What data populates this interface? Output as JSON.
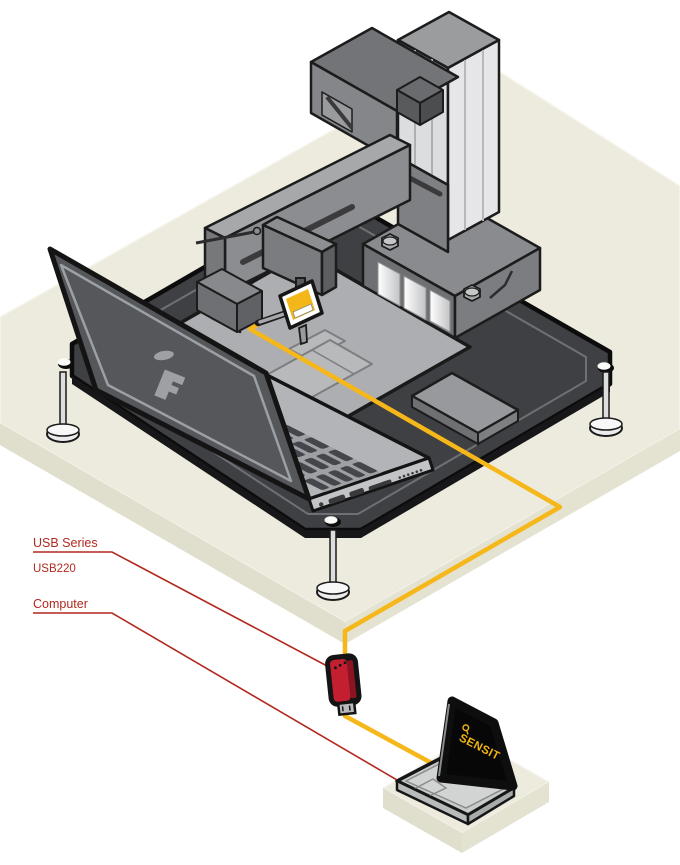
{
  "illustration": {
    "description": "Isometric technical diagram: laptop test machine on platform, connected by cable through a USB adapter to a computer",
    "callouts": [
      {
        "label": "USB Series",
        "sublabel": "USB220",
        "target": "usb-adapter"
      },
      {
        "label": "Computer",
        "target": "computer-laptop"
      }
    ],
    "callout_color": "#b2291f",
    "cable_color": "#f6b71b",
    "usb_adapter_color": "#c41f30",
    "computer_screen_logo": "SENSIT",
    "computer_screen_logo_color": "#f0b411",
    "platform_color": "#3f4043",
    "table_color": "#edebdd",
    "machine_gray": "#8a8b8e",
    "test_laptop_lid_color": "#55575a"
  }
}
